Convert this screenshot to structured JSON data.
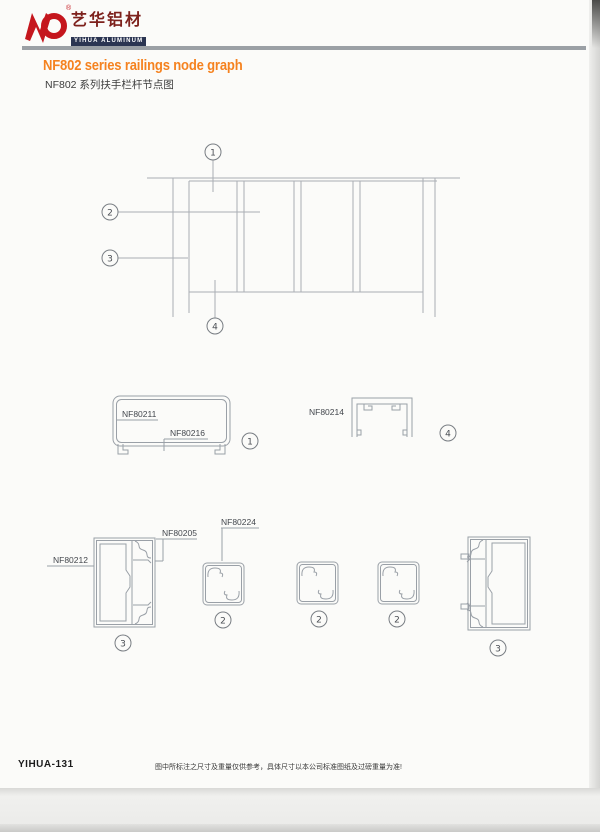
{
  "brand": {
    "name_cn": "艺华铝材",
    "name_en": "YIHUA ALUMINUM",
    "registered": "®"
  },
  "header": {
    "title_en": "NF802 series railings node graph",
    "title_cn": "NF802 系列扶手栏杆节点图"
  },
  "drawing": {
    "callout_1": "1",
    "callout_2": "2",
    "callout_3": "3",
    "callout_4": "4"
  },
  "profile_labels": {
    "nf80211": "NF80211",
    "nf80216": "NF80216",
    "nf80214": "NF80214",
    "nf80212": "NF80212",
    "nf80205": "NF80205",
    "nf80224": "NF80224"
  },
  "footer": {
    "page_code": "YIHUA-131",
    "note": "图中所标注之尺寸及重量仅供参考，具体尺寸以本公司标准图纸及过磅重量为准!"
  },
  "colors": {
    "accent_orange": "#f5821f",
    "brand_red": "#c5161d",
    "brand_dark_red": "#7d211c",
    "brand_navy": "#2b3552",
    "line_gray": "#a9aeb4",
    "divider_gray": "#9ba0a5"
  }
}
